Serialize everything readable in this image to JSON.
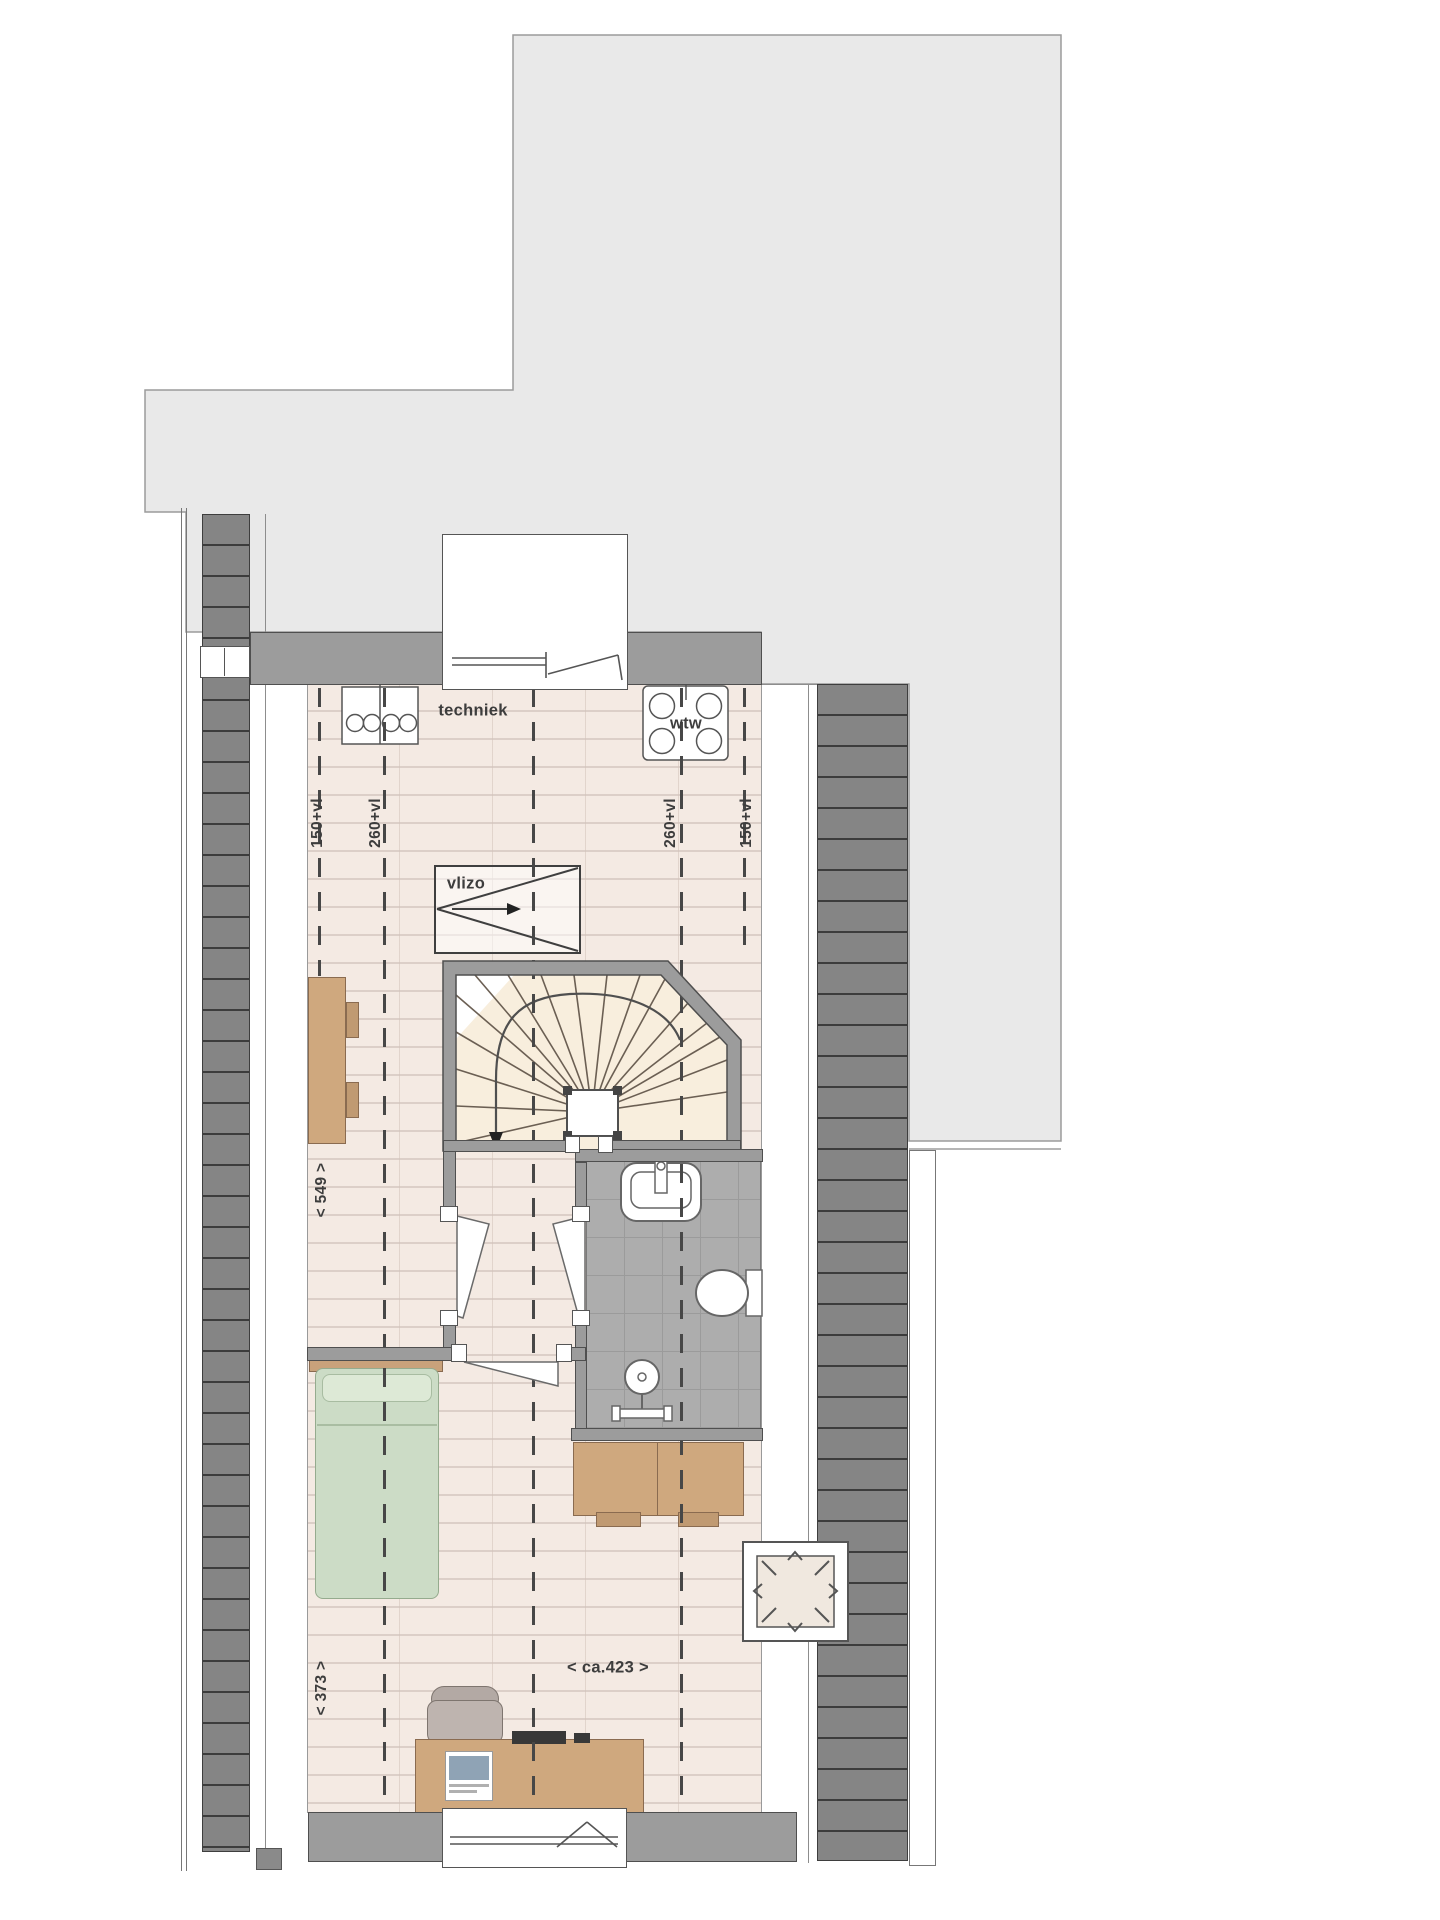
{
  "plan": {
    "kind": "attic floor plan",
    "labels": {
      "techniek": "techniek",
      "wtw": "wtw",
      "vlizo": "vlizo",
      "dim_150_left": "150+vl",
      "dim_260_left": "260+vl",
      "dim_260_right": "260+vl",
      "dim_150_right": "150+vl",
      "dim_depth": "< 549 >",
      "dim_width_left": "< 373 >",
      "dim_width_main": "< ca.423 >"
    },
    "fixtures": [
      "stair-winder",
      "vlizo-hatch",
      "wtw-unit",
      "washer-connection",
      "sink",
      "toilet",
      "shower",
      "roof-window",
      "dormer-window",
      "bottom-window",
      "bed",
      "desk",
      "sideboard",
      "armchair"
    ],
    "colors": {
      "terrace_roof": "#e9e9e9",
      "wall": "#9c9c9c",
      "roof_slope_band": "#858585",
      "floor_planks": "#f4eae3",
      "bathroom_tiles": "#adadad",
      "furniture_wood": "#cfa87e",
      "bed_green": "#ccdcc6",
      "stair_fill": "#f8eedd",
      "line_dark": "#4f4f4f"
    }
  }
}
